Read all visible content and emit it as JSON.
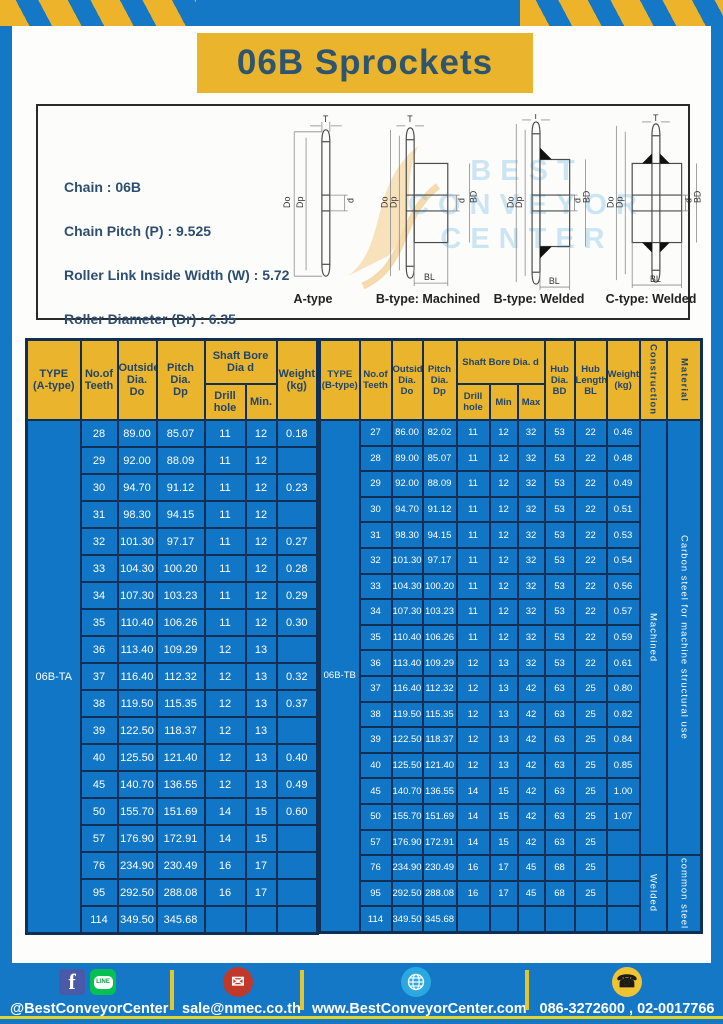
{
  "page": {
    "title": "06B Sprockets"
  },
  "specs": {
    "lines": [
      "Chain  : 06B",
      "Chain Pitch (P)  :  9.525",
      "Roller Link Inside Width (W)  :  5.72",
      "Roller Diameter (Dr)  : 6.35",
      "Teeth Width (T)  :  5.3"
    ]
  },
  "diagrams": {
    "labels": [
      "A-type",
      "B-type: Machined",
      "B-type: Welded",
      "C-type: Welded"
    ],
    "dims": {
      "t": "T",
      "dia_o": "Do",
      "dia_p": "Dp",
      "d": "d",
      "bd": "BD",
      "bl": "BL"
    },
    "watermark": [
      "BEST",
      "CONVEYOR",
      "CENTER"
    ]
  },
  "left_table": {
    "type_label": "06B-TA",
    "header": {
      "type": "TYPE\n(A-type)",
      "teeth": "No.of\nTeeth",
      "outside": "Outside\nDia.\nDo",
      "pitch": "Pitch Dia.\nDp",
      "shaft_group": "Shaft Bore Dia d",
      "drill": "Drill hole",
      "min": "Min.",
      "weight": "Weight\n(kg)"
    },
    "rows": [
      [
        "28",
        "89.00",
        "85.07",
        "11",
        "12",
        "0.18"
      ],
      [
        "29",
        "92.00",
        "88.09",
        "11",
        "12",
        ""
      ],
      [
        "30",
        "94.70",
        "91.12",
        "11",
        "12",
        "0.23"
      ],
      [
        "31",
        "98.30",
        "94.15",
        "11",
        "12",
        ""
      ],
      [
        "32",
        "101.30",
        "97.17",
        "11",
        "12",
        "0.27"
      ],
      [
        "33",
        "104.30",
        "100.20",
        "11",
        "12",
        "0.28"
      ],
      [
        "34",
        "107.30",
        "103.23",
        "11",
        "12",
        "0.29"
      ],
      [
        "35",
        "110.40",
        "106.26",
        "11",
        "12",
        "0.30"
      ],
      [
        "36",
        "113.40",
        "109.29",
        "12",
        "13",
        ""
      ],
      [
        "37",
        "116.40",
        "112.32",
        "12",
        "13",
        "0.32"
      ],
      [
        "38",
        "119.50",
        "115.35",
        "12",
        "13",
        "0.37"
      ],
      [
        "39",
        "122.50",
        "118.37",
        "12",
        "13",
        ""
      ],
      [
        "40",
        "125.50",
        "121.40",
        "12",
        "13",
        "0.40"
      ],
      [
        "45",
        "140.70",
        "136.55",
        "12",
        "13",
        "0.49"
      ],
      [
        "50",
        "155.70",
        "151.69",
        "14",
        "15",
        "0.60"
      ],
      [
        "57",
        "176.90",
        "172.91",
        "14",
        "15",
        ""
      ],
      [
        "76",
        "234.90",
        "230.49",
        "16",
        "17",
        ""
      ],
      [
        "95",
        "292.50",
        "288.08",
        "16",
        "17",
        ""
      ],
      [
        "114",
        "349.50",
        "345.68",
        "",
        "",
        ""
      ]
    ]
  },
  "right_table": {
    "type_label": "06B-TB",
    "header": {
      "type": "TYPE\n(B-type)",
      "teeth": "No.of\nTeeth",
      "outside": "Outside\nDia.\nDo",
      "pitch": "Pitch\nDia.\nDp",
      "shaft_group": "Shaft Bore Dia.  d",
      "drill": "Drill hole",
      "min": "Min",
      "max": "Max",
      "hub_dia": "Hub\nDia.\nBD",
      "hub_len": "Hub\nLength\nBL",
      "weight": "Weight\n(kg)",
      "construction": "Construction",
      "material": "Material"
    },
    "rows": [
      [
        "27",
        "86.00",
        "82.02",
        "11",
        "12",
        "32",
        "53",
        "22",
        "0.46"
      ],
      [
        "28",
        "89.00",
        "85.07",
        "11",
        "12",
        "32",
        "53",
        "22",
        "0.48"
      ],
      [
        "29",
        "92.00",
        "88.09",
        "11",
        "12",
        "32",
        "53",
        "22",
        "0.49"
      ],
      [
        "30",
        "94.70",
        "91.12",
        "11",
        "12",
        "32",
        "53",
        "22",
        "0.51"
      ],
      [
        "31",
        "98.30",
        "94.15",
        "11",
        "12",
        "32",
        "53",
        "22",
        "0.53"
      ],
      [
        "32",
        "101.30",
        "97.17",
        "11",
        "12",
        "32",
        "53",
        "22",
        "0.54"
      ],
      [
        "33",
        "104.30",
        "100.20",
        "11",
        "12",
        "32",
        "53",
        "22",
        "0.56"
      ],
      [
        "34",
        "107.30",
        "103.23",
        "11",
        "12",
        "32",
        "53",
        "22",
        "0.57"
      ],
      [
        "35",
        "110.40",
        "106.26",
        "11",
        "12",
        "32",
        "53",
        "22",
        "0.59"
      ],
      [
        "36",
        "113.40",
        "109.29",
        "12",
        "13",
        "32",
        "53",
        "22",
        "0.61"
      ],
      [
        "37",
        "116.40",
        "112.32",
        "12",
        "13",
        "42",
        "63",
        "25",
        "0.80"
      ],
      [
        "38",
        "119.50",
        "115.35",
        "12",
        "13",
        "42",
        "63",
        "25",
        "0.82"
      ],
      [
        "39",
        "122.50",
        "118.37",
        "12",
        "13",
        "42",
        "63",
        "25",
        "0.84"
      ],
      [
        "40",
        "125.50",
        "121.40",
        "12",
        "13",
        "42",
        "63",
        "25",
        "0.85"
      ],
      [
        "45",
        "140.70",
        "136.55",
        "14",
        "15",
        "42",
        "63",
        "25",
        "1.00"
      ],
      [
        "50",
        "155.70",
        "151.69",
        "14",
        "15",
        "42",
        "63",
        "25",
        "1.07"
      ],
      [
        "57",
        "176.90",
        "172.91",
        "14",
        "15",
        "42",
        "63",
        "25",
        ""
      ],
      [
        "76",
        "234.90",
        "230.49",
        "16",
        "17",
        "45",
        "68",
        "25",
        ""
      ],
      [
        "95",
        "292.50",
        "288.08",
        "16",
        "17",
        "45",
        "68",
        "25",
        ""
      ],
      [
        "114",
        "349.50",
        "345.68",
        "",
        "",
        "",
        "",
        "",
        ""
      ]
    ],
    "construction_spans": [
      {
        "label": "Machined",
        "rows": 17
      },
      {
        "label": "Welded",
        "rows": 3
      }
    ],
    "material_spans": [
      {
        "label": "Carbon  steel  for  machine  structural  use",
        "rows": 17
      },
      {
        "label": "common steel",
        "rows": 3
      }
    ]
  },
  "footer": {
    "facebook_letter": "f",
    "line_label": "LINE",
    "social_text": "@BestConveyorCenter",
    "email_icon": "✉",
    "email": "sale@nmec.co.th",
    "website": "www.BestConveyorCenter.com",
    "phone_icon": "☎",
    "phone": "086-3272600 , 02-0017766"
  },
  "colors": {
    "frame_blue": "#1478c6",
    "cell_blue": "#1176c6",
    "accent_yellow": "#eab42c",
    "table_border_navy": "#0f2f55",
    "title_text": "#2e5570"
  }
}
